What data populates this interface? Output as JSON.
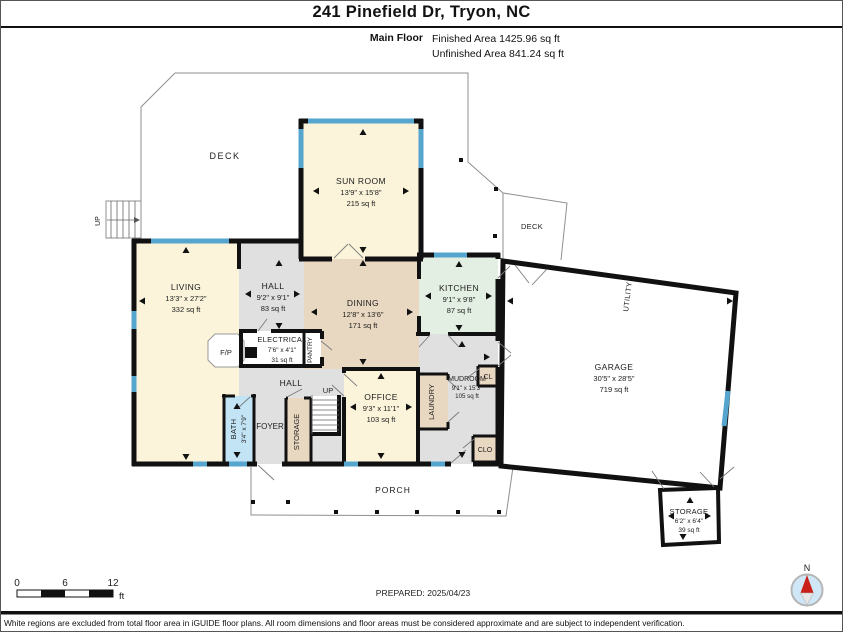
{
  "header": {
    "title": "241 Pinefield Dr, Tryon, NC",
    "floor_label": "Main Floor",
    "finished_area": "Finished Area 1425.96 sq ft",
    "unfinished_area": "Unfinished Area 841.24 sq ft"
  },
  "rooms": {
    "deck_nw": {
      "name": "DECK"
    },
    "deck_e": {
      "name": "DECK"
    },
    "sunroom": {
      "name": "SUN ROOM",
      "dims": "13'9\" x 15'8\"",
      "area": "215 sq ft"
    },
    "living": {
      "name": "LIVING",
      "dims": "13'3\" x 27'2\"",
      "area": "332 sq ft"
    },
    "hall_upper": {
      "name": "HALL",
      "dims": "9'2\" x 9'1\"",
      "area": "83 sq ft"
    },
    "dining": {
      "name": "DINING",
      "dims": "12'8\" x 13'6\"",
      "area": "171 sq ft"
    },
    "kitchen": {
      "name": "KITCHEN",
      "dims": "9'1\" x 9'8\"",
      "area": "87 sq ft"
    },
    "electrical": {
      "name": "ELECTRICAL",
      "dims": "7'6\" x 4'1\"",
      "area": "31 sq ft"
    },
    "fireplace": {
      "name": "F/P"
    },
    "pantry": {
      "name": "PANTRY"
    },
    "hall_lower": {
      "name": "HALL"
    },
    "stairs_deck": {
      "name": "UP"
    },
    "stairs_main": {
      "name": "UP"
    },
    "office": {
      "name": "OFFICE",
      "dims": "9'3\" x 11'1\"",
      "area": "103 sq ft"
    },
    "laundry": {
      "name": "LAUNDRY"
    },
    "mudroom": {
      "name": "MUDROOM",
      "dims": "9'1\" x 15'3\"",
      "area": "105 sq ft"
    },
    "closet_upper": {
      "name": "CL"
    },
    "closet_lower": {
      "name": "CLO"
    },
    "bath": {
      "name": "BATH",
      "dims": "3'4\" x 7'9\""
    },
    "foyer": {
      "name": "FOYER"
    },
    "storage_mid": {
      "name": "STORAGE"
    },
    "garage": {
      "name": "GARAGE",
      "dims": "30'5\" x 28'5\"",
      "area": "719 sq ft"
    },
    "utility": {
      "name": "UTILITY"
    },
    "storage_se": {
      "name": "STORAGE",
      "dims": "6'2\" x 6'4\"",
      "area": "39 sq ft"
    },
    "porch": {
      "name": "PORCH"
    }
  },
  "footer": {
    "scale": {
      "tick0": "0",
      "tick1": "6",
      "tick2": "12",
      "unit": "ft"
    },
    "prepared": "PREPARED: 2025/04/23",
    "compass_north": "N",
    "disclaimer": "White regions are excluded from total floor area in iGUIDE floor plans. All room dimensions and floor areas must be considered approximate and are subject to independent verification."
  },
  "colors": {
    "finished_cream": "#fbf4da",
    "tan": "#e9d8c1",
    "hall_gray": "#e0e0e0",
    "kitchen_mint": "#e3efe3",
    "bath_blue": "#c3e4f5",
    "window_blue": "#55a5ce",
    "wall_black": "#111111",
    "compass_blue": "#cfe7f6",
    "compass_red": "#c9211a"
  }
}
